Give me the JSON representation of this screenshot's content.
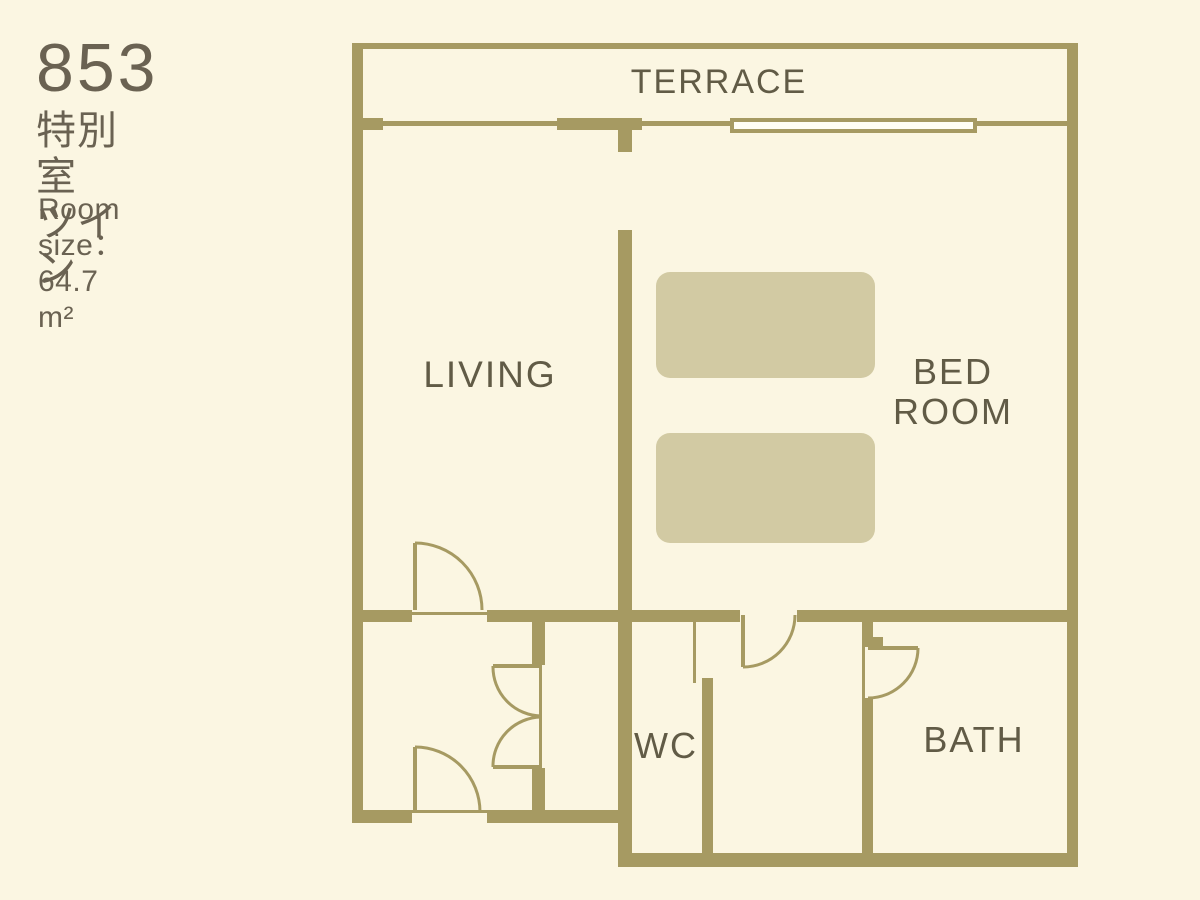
{
  "title": {
    "room_number": "853",
    "room_type": "特別室　ツイン",
    "room_size": "Room size：64.7 m²"
  },
  "labels": {
    "terrace": "TERRACE",
    "living": "LIVING",
    "bedroom_line1": "BED",
    "bedroom_line2": "ROOM",
    "wc": "WC",
    "bath": "BATH"
  },
  "colors": {
    "background": "#FBF6E2",
    "wall": "#A69A62",
    "bed": "#D2CAA3",
    "label_text": "#615B46",
    "title_text": "#6A6252",
    "window_fill": "#FFFEF4"
  }
}
